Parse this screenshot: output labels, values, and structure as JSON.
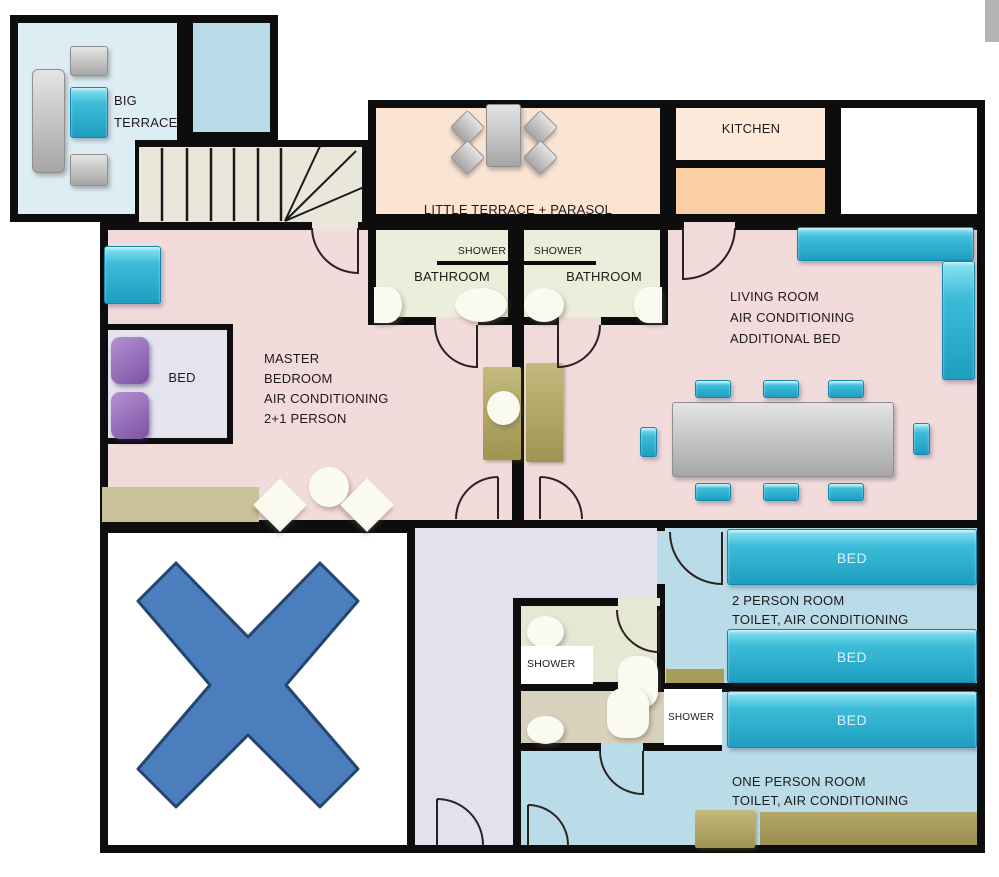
{
  "rooms": {
    "big_terrace": {
      "line1": "BIG",
      "line2": "TERRACE"
    },
    "little_terrace": {
      "label": "LITTLE TERRACE + PARASOL"
    },
    "kitchen": {
      "label": "KITCHEN"
    },
    "bathroom_left": {
      "shower": "SHOWER",
      "name": "BATHROOM"
    },
    "bathroom_right": {
      "shower": "SHOWER",
      "name": "BATHROOM"
    },
    "living_room": {
      "line1": "LIVING ROOM",
      "line2": "AIR CONDITIONING",
      "line3": "ADDITIONAL BED"
    },
    "master_bedroom": {
      "bed": "BED",
      "line1": "MASTER",
      "line2": "BEDROOM",
      "line3": "AIR CONDITIONING",
      "line4": "2+1 PERSON"
    },
    "two_person_room": {
      "bed_top": "BED",
      "bed_bottom": "BED",
      "line1": "2 PERSON ROOM",
      "line2": "TOILET, AIR CONDITIONING"
    },
    "one_person_room": {
      "bed": "BED",
      "line1": "ONE PERSON ROOM",
      "line2": "TOILET, AIR CONDITIONING"
    },
    "shower_room_upper": {
      "label": "SHOWER"
    },
    "shower_room_lower": {
      "label": "SHOWER"
    }
  },
  "colors": {
    "wall": "#0d0d0d",
    "terrace_floor": "#ddedf4",
    "small_blue_room": "#b9dbe7",
    "stairs": "#e9e6da",
    "little_terrace_floor": "#fce4d2",
    "kitchen_floor": "#fdeadb",
    "kitchen_counter": "#fbcfa4",
    "main_floor_pink": "#f2dbdb",
    "bathroom_floor": "#eaeeda",
    "hall_lavender": "#e3e1ee",
    "bedroom_blue": "#b9dce8",
    "shower_lower_tan": "#d8d2bd",
    "furniture_cyan": "#2fb4d4",
    "furniture_gray": "#b5b5b5",
    "furniture_olive": "#afa465",
    "pillow_purple": "#8f66b5",
    "x_marker_blue": "#4a7ebc"
  }
}
